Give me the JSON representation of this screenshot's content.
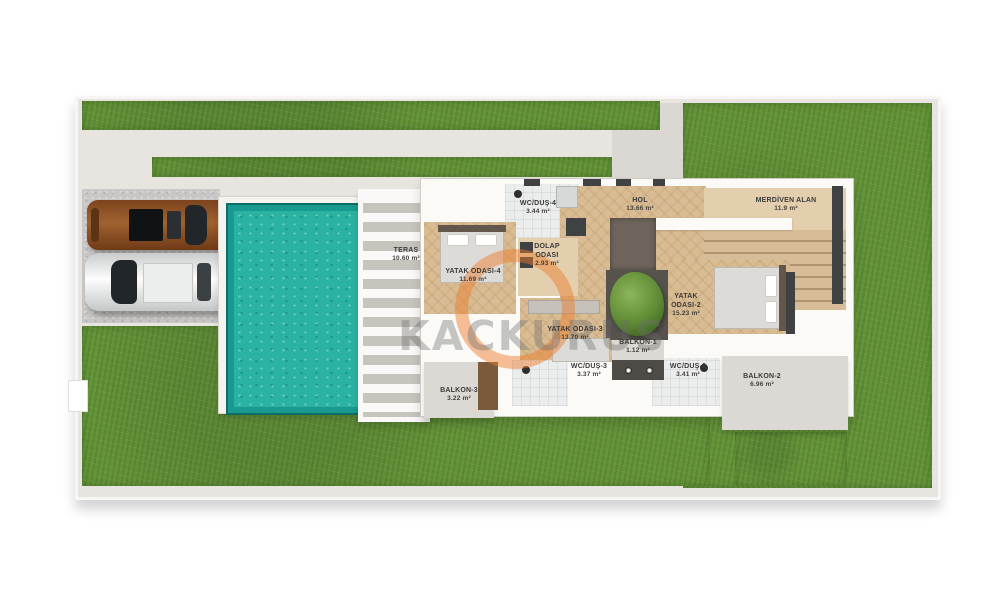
{
  "watermark": {
    "text": "KACKURUS",
    "ring_color": "#ec7c2c"
  },
  "rooms": {
    "teras": {
      "name": "TERAS",
      "area": "10.60 m²"
    },
    "wc_dus_4": {
      "name": "WC/DUŞ-4",
      "area": "3.44 m²"
    },
    "hol": {
      "name": "HOL",
      "area": "13.66 m²"
    },
    "merdiven_alan": {
      "name": "MERDİVEN ALAN",
      "area": "11.9 m²"
    },
    "yatak_odasi_4": {
      "name": "YATAK ODASI-4",
      "area": "11.69 m²"
    },
    "dolap_odasi": {
      "name": "DOLAP ODASI",
      "area": "2.93 m²"
    },
    "yatak_odasi_3": {
      "name": "YATAK ODASI-3",
      "area": "13.70 m²"
    },
    "balkon_1": {
      "name": "BALKON-1",
      "area": "1.12 m²"
    },
    "yatak_odasi_2": {
      "name": "YATAK ODASI-2",
      "area": "15.23 m²"
    },
    "wc_dus_3": {
      "name": "WC/DUŞ-3",
      "area": "3.37 m²"
    },
    "wc_dus_2": {
      "name": "WC/DUŞ-2",
      "area": "3.41 m²"
    },
    "balkon_3": {
      "name": "BALKON-3",
      "area": "3.22 m²"
    },
    "balkon_2": {
      "name": "BALKON-2",
      "area": "6.96 m²"
    }
  },
  "colors": {
    "grass": "#649338",
    "pool": "#2ab3a3",
    "wood_floor": "#d9bc93",
    "site_plate": "#e8e5e0",
    "dark_wall": "#3f4142",
    "car_bronze": "#8d5026",
    "car_white": "#f3f4f4"
  }
}
